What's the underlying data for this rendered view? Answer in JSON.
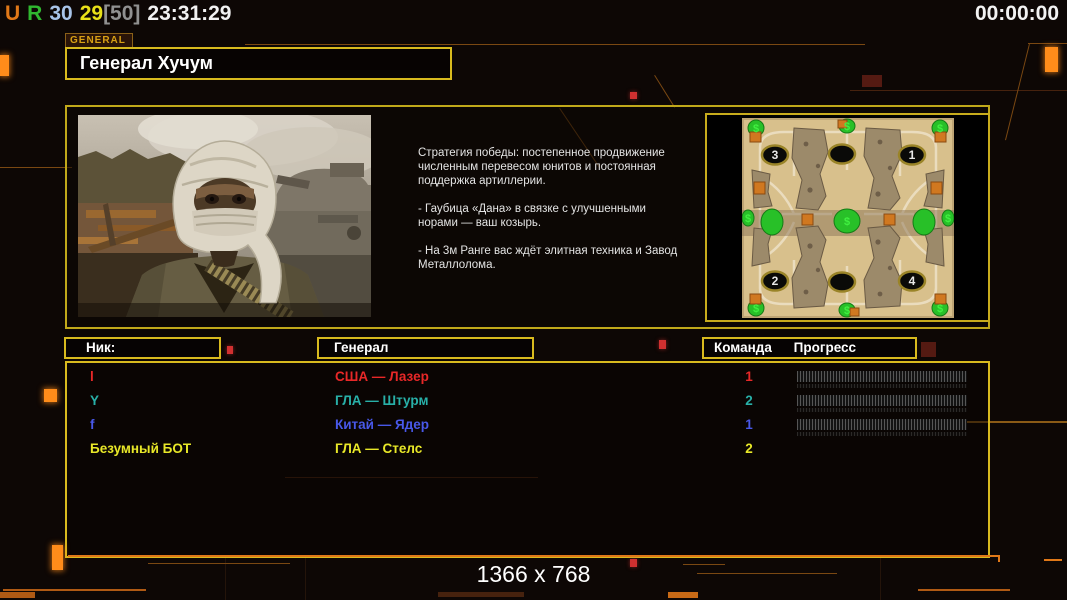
{
  "top_bar": {
    "tokens": [
      {
        "text": "U",
        "color": "#e07818"
      },
      {
        "text": "R",
        "color": "#30b830"
      },
      {
        "text": "30",
        "color": "#a8c4e8"
      },
      {
        "text": "29",
        "color": "#e8e018",
        "tight": true
      },
      {
        "text": "[50]",
        "color": "#909090"
      },
      {
        "text": "23:31:29",
        "color": "#f2f2f2"
      }
    ],
    "timer": "00:00:00"
  },
  "general_tab": {
    "label": "GENERAL"
  },
  "title": {
    "text": "Генерал Хучум"
  },
  "description": {
    "paragraphs": [
      "Стратегия победы: постепенное продвижение численным перевесом юнитов и постоянная поддержка артиллерии.",
      "- Гаубица «Дана» в связке с улучшенными норами — ваш козырь.",
      "- На 3м Ранге вас ждёт элитная техника и Завод Металлолома."
    ]
  },
  "minimap": {
    "positions": {
      "p1": "1",
      "p2": "2",
      "p3": "3",
      "p4": "4"
    },
    "money_symbol": "$"
  },
  "table": {
    "headers": {
      "nick": "Ник:",
      "general": "Генерал",
      "team": "Команда",
      "progress": "Прогресс"
    },
    "rows": [
      {
        "nick": "l",
        "general": "США — Лазер",
        "team": "1",
        "color": "#e82828",
        "has_progress": true
      },
      {
        "nick": "Y",
        "general": "ГЛА — Штурм",
        "team": "2",
        "color": "#28b0a8",
        "has_progress": true
      },
      {
        "nick": "f",
        "general": "Китай — Ядер",
        "team": "1",
        "color": "#4858e8",
        "has_progress": true
      },
      {
        "nick": "Безумный БОТ",
        "general": "ГЛА — Стелс",
        "team": "2",
        "color": "#e8e828",
        "has_progress": false
      }
    ]
  },
  "footer": {
    "resolution": "1366 x 768"
  },
  "colors": {
    "border_gold": "#d8ba1e",
    "accent_orange": "#e07818",
    "background": "#0d0705"
  }
}
